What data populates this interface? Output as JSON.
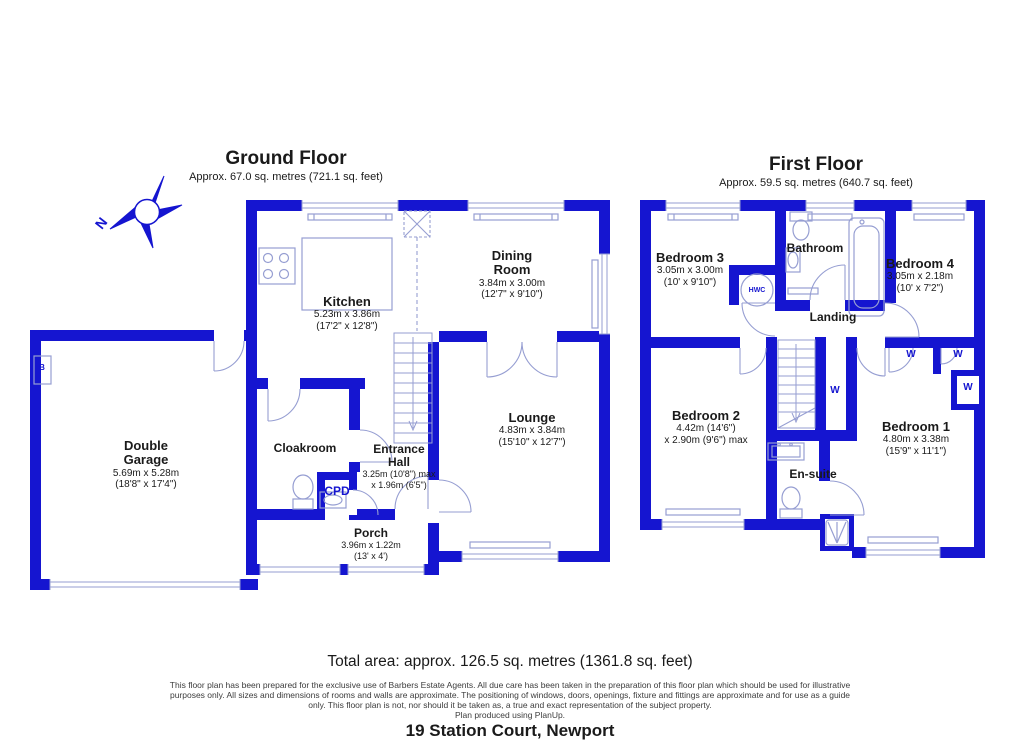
{
  "colors": {
    "wall_blue": "#1515d0",
    "fixture_line": "#969ed2",
    "text_dark": "#1a1a1a"
  },
  "compass": {
    "north_label": "N"
  },
  "ground_floor": {
    "title": "Ground Floor",
    "subtitle": "Approx. 67.0 sq. metres (721.1 sq. feet)",
    "rooms": {
      "kitchen": {
        "name": "Kitchen",
        "metric": "5.23m x 3.86m",
        "imperial": "(17'2\" x 12'8\")"
      },
      "dining_room": {
        "name": "Dining Room",
        "metric": "3.84m x 3.00m",
        "imperial": "(12'7\" x 9'10\")"
      },
      "lounge": {
        "name": "Lounge",
        "metric": "4.83m x 3.84m",
        "imperial": "(15'10\" x 12'7\")"
      },
      "double_garage": {
        "name": "Double Garage",
        "metric": "5.69m x 5.28m",
        "imperial": "(18'8\" x 17'4\")"
      },
      "cloakroom": {
        "name": "Cloakroom"
      },
      "entrance_hall": {
        "name": "Entrance Hall",
        "metric": "3.25m (10'8\") max",
        "imperial": "x 1.96m (6'5\")"
      },
      "cpd": {
        "name": "CPD"
      },
      "porch": {
        "name": "Porch",
        "metric": "3.96m x 1.22m",
        "imperial": "(13' x 4')"
      },
      "boiler": {
        "name": "B"
      }
    }
  },
  "first_floor": {
    "title": "First Floor",
    "subtitle": "Approx. 59.5 sq. metres (640.7 sq. feet)",
    "rooms": {
      "bedroom_3": {
        "name": "Bedroom 3",
        "metric": "3.05m x 3.00m",
        "imperial": "(10' x 9'10\")"
      },
      "bathroom": {
        "name": "Bathroom"
      },
      "bedroom_4": {
        "name": "Bedroom 4",
        "metric": "3.05m x 2.18m",
        "imperial": "(10' x 7'2\")"
      },
      "hwc": {
        "name": "HWC"
      },
      "landing": {
        "name": "Landing"
      },
      "bedroom_2": {
        "name": "Bedroom 2",
        "metric": "4.42m (14'6\")",
        "imperial": "x 2.90m (9'6\") max"
      },
      "bedroom_1": {
        "name": "Bedroom 1",
        "metric": "4.80m x 3.38m",
        "imperial": "(15'9\" x 11'1\")"
      },
      "en_suite": {
        "name": "En-suite"
      },
      "wardrobes": {
        "labels": [
          "W",
          "W",
          "W",
          "W"
        ]
      }
    }
  },
  "footer": {
    "total_area": "Total area: approx. 126.5 sq. metres (1361.8 sq. feet)",
    "disclaimer": [
      "This floor plan has been prepared for the exclusive use of Barbers Estate Agents. All due care has been taken in the preparation of this floor plan which should be used for illustrative",
      "purposes only. All sizes and dimensions of rooms and walls are approximate. The positioning of windows, doors, openings, fixture and fittings are approximate and for use as a guide",
      "only. This floor plan is not, nor should it be taken as, a true and exact representation of the subject property.",
      "Plan produced using PlanUp."
    ],
    "address": "19 Station Court, Newport"
  }
}
